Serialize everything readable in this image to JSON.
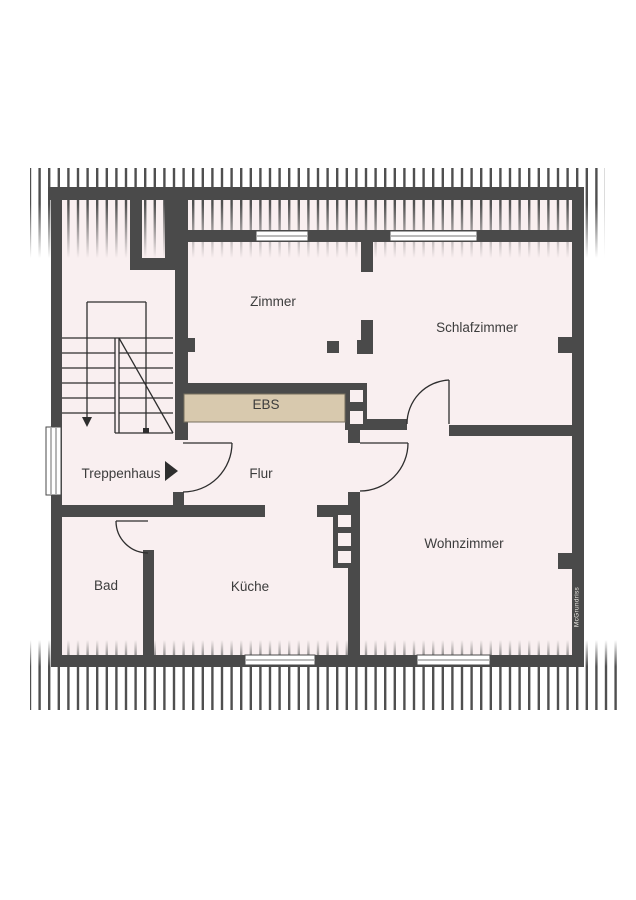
{
  "title": "Dachgeschoss Grundriss",
  "colors": {
    "wall": "#4a4a4a",
    "room_fill": "#f9eff0",
    "ebs_fill": "#d8c9ae",
    "line": "#2e2e2e",
    "text": "#3c3c3c",
    "watermark": "#efece6",
    "window": "#ffffff",
    "hatch": "#4f4f4f"
  },
  "labels": {
    "zimmer": "Zimmer",
    "schlafzimmer": "Schlafzimmer",
    "ebs": "EBS",
    "treppenhaus": "Treppenhaus",
    "flur": "Flur",
    "bad": "Bad",
    "kueche": "Küche",
    "wohnzimmer": "Wohnzimmer"
  },
  "watermark": "McGrundriss"
}
